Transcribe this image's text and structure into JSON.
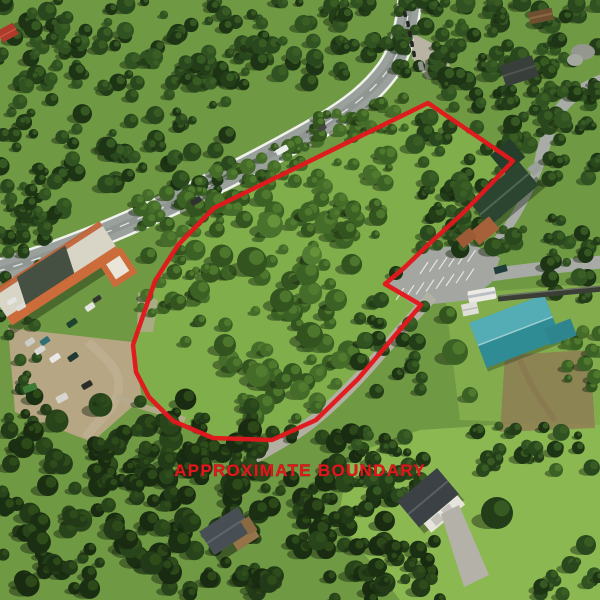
{
  "annotation": {
    "label": "APPROXIMATE BOUNDARY",
    "color": "#e2181d",
    "boundary_points": "428,103 513,161 462,214 430,243 404,268 385,284 421,305 358,379 316,420 272,440 213,438 173,421 149,397 136,372 133,345 155,281 178,245 214,208"
  },
  "scene": {
    "setting": "aerial drone photo of forested mountain property with red outline overlay",
    "features": [
      {
        "name": "highway",
        "color": "#9aa19c"
      },
      {
        "name": "commercial-building-orange-roof",
        "color": "#cd6c3b"
      },
      {
        "name": "store-parking-lot",
        "color": "#b7a684"
      },
      {
        "name": "green-roof-lodge",
        "color": "#2c4531"
      },
      {
        "name": "gravel-parking-lot",
        "color": "#a4a7a1"
      },
      {
        "name": "rv-trailer",
        "color": "#eceae4"
      },
      {
        "name": "teal-roof-building",
        "color": "#3d98a0"
      },
      {
        "name": "grey-roof-house",
        "color": "#3b4145"
      },
      {
        "name": "hidden-cabin",
        "color": "#474f54"
      },
      {
        "name": "conifer-forest",
        "color": "#2a481d"
      },
      {
        "name": "meadow",
        "color": "#7fae4b"
      }
    ]
  }
}
